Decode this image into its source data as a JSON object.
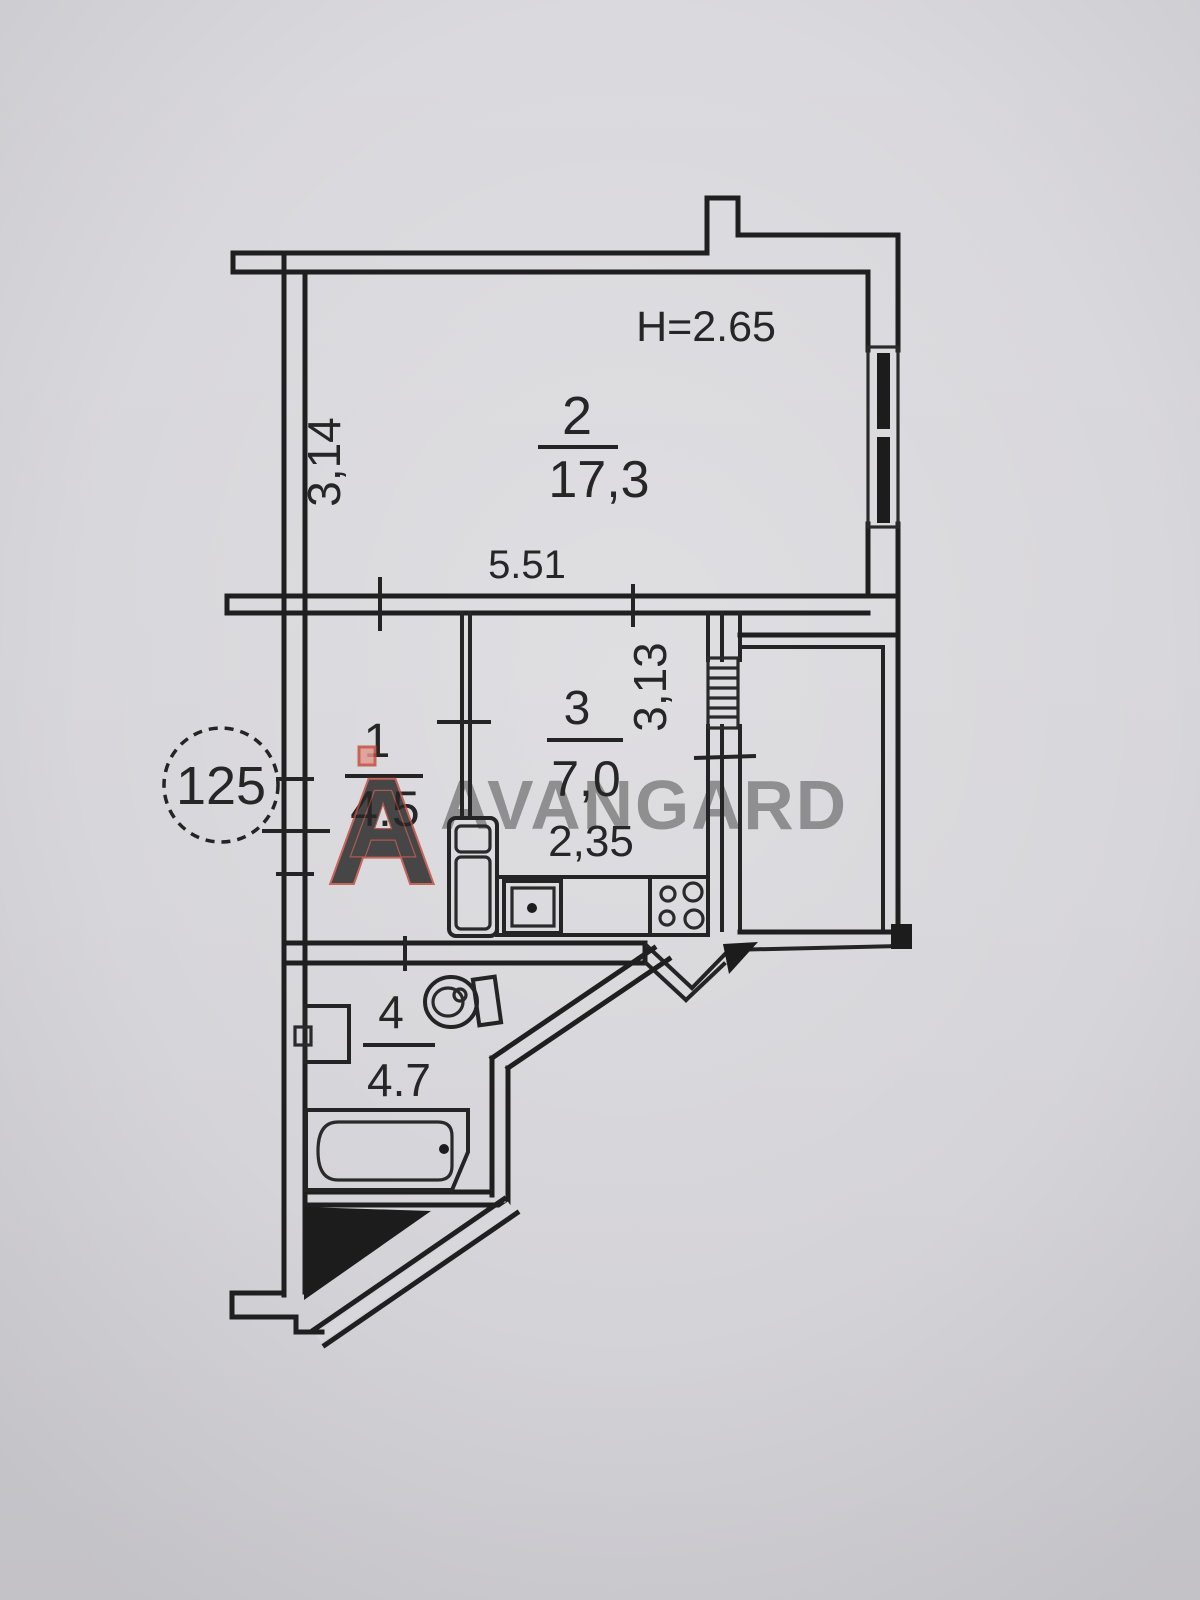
{
  "plan": {
    "apartment_number": "125",
    "ceiling_height_label": "H=2.65",
    "rooms": [
      {
        "id": "1",
        "area": "4.5",
        "name": "hallway"
      },
      {
        "id": "2",
        "area": "17,3",
        "name": "living-room"
      },
      {
        "id": "3",
        "area": "7,0",
        "name": "kitchen"
      },
      {
        "id": "4",
        "area": "4.7",
        "name": "bathroom"
      }
    ],
    "dimensions": {
      "room2_depth": "3,14",
      "room2_width": "5.51",
      "kitchen_width": "2,35",
      "kitchen_depth": "3,13"
    },
    "colors": {
      "paper": "#d8d7db",
      "ink": "#1f1f1f"
    }
  },
  "watermark": {
    "brand_text": "AVANGARD",
    "logo_letter": "A",
    "logo_fill": "#e2998f",
    "logo_stroke": "#c24b3e",
    "text_color": "#5c6a86"
  }
}
